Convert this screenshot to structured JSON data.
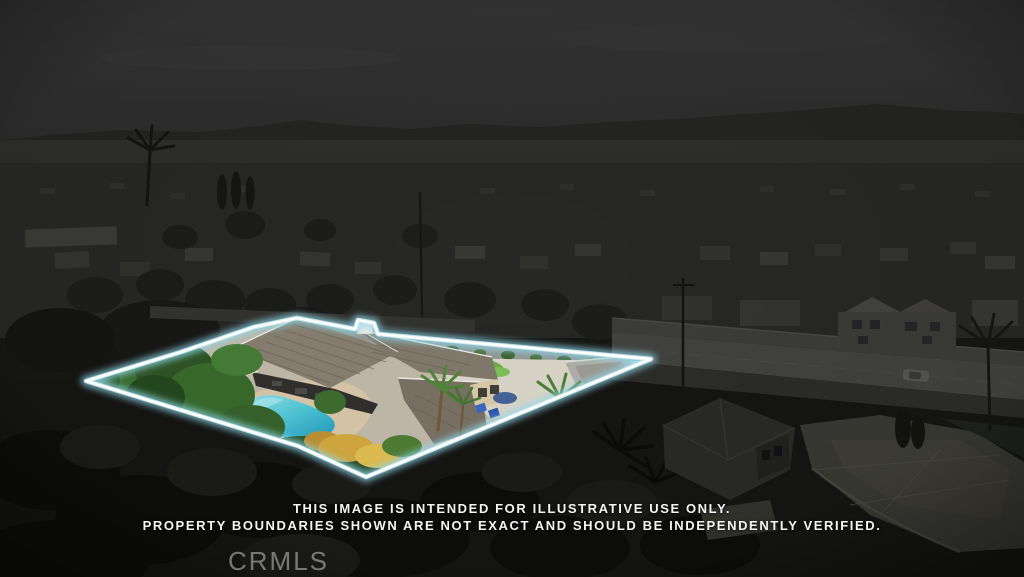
{
  "disclaimer": {
    "line1": "THIS IMAGE IS INTENDED FOR ILLUSTRATIVE USE ONLY.",
    "line2": "PROPERTY BOUNDARIES SHOWN ARE NOT EXACT AND SHOULD BE INDEPENDENTLY VERIFIED."
  },
  "watermark": {
    "label": "CRMLS"
  },
  "colors": {
    "boundary_core": "#ffffff",
    "boundary_glow": "#8fd9ec",
    "pool_water": "#2e9fb8",
    "background_dim": "#1a1a18",
    "disclaimer_text": "#f4f4f4"
  }
}
